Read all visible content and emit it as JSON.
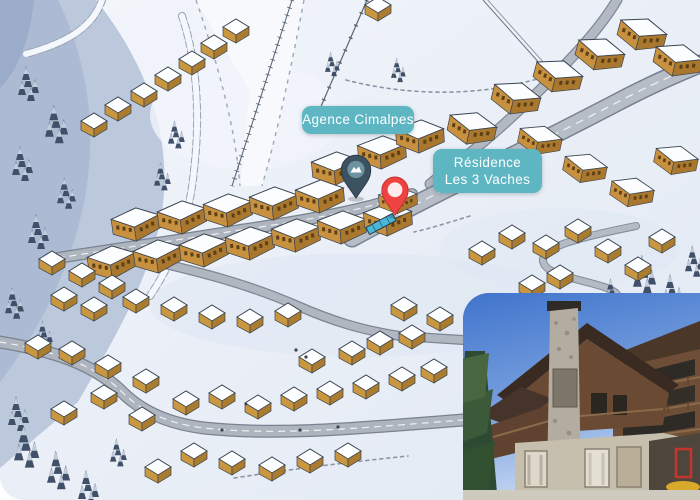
{
  "map": {
    "name": "illustrated-resort-village-map",
    "labels": {
      "agency": "Agence Cimalpes",
      "residence_line1": "Résidence",
      "residence_line2": "Les 3 Vaches"
    },
    "pins": {
      "agency": {
        "color": "#3c5260",
        "stroke": "#2b3d49",
        "inner_color": "#6e93a0"
      },
      "residence": {
        "color": "#ee4340",
        "stroke": "#c0322f",
        "inner_color": "#fdeceb"
      }
    },
    "colors": {
      "label_background": "#5eb6c3",
      "label_text": "#ffffff",
      "snow": "#edf1f8",
      "mountain_shade": "#b9c6db",
      "road": "#aeb5bf",
      "building_wall": "#c8973f",
      "building_roof": "#fbfdff",
      "tree": "#3f5068",
      "piste": "#f7f9fd",
      "escalator": "#49b7d8"
    }
  },
  "inset_photo": {
    "name": "residence-exterior-photo",
    "colors": {
      "sky": "#4679cf",
      "roof": "#3a2b22",
      "wood_facade": "#6e4e36",
      "stone_chimney": "#b3aca0",
      "stone_ground": "#c6bfae",
      "pine_tree": "#2f4a33",
      "sign_red": "#c4362d",
      "awning_yellow": "#d9a92c"
    }
  }
}
